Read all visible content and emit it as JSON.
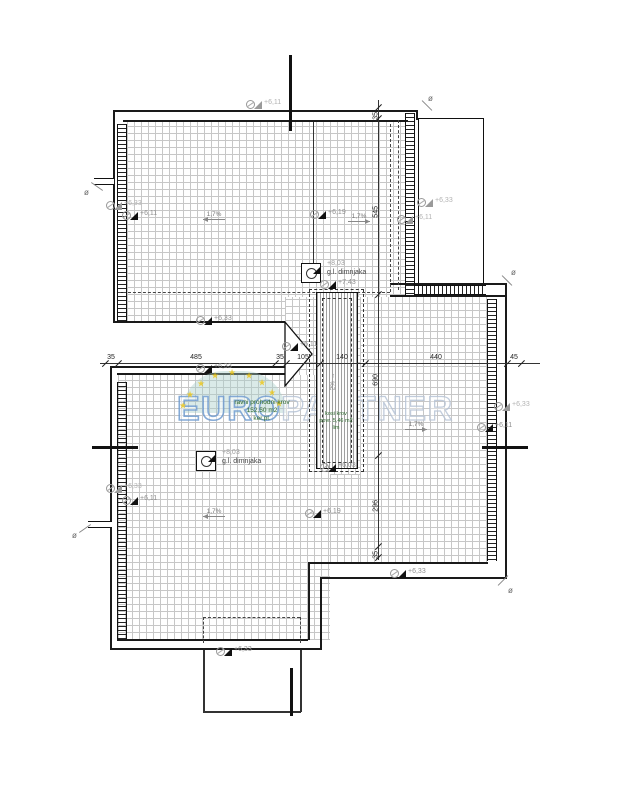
{
  "plan": {
    "watermark": {
      "euro": "EURO",
      "partner": "PARTNER"
    },
    "area_labels": {
      "flat_roof": {
        "l1": "ravni prohodni krov",
        "l2": "152,50 m2",
        "l3": "ker.pl."
      },
      "sloped_roof": {
        "l1": "kosi krov",
        "l2": "povr. 5,46 m2",
        "l3": "lim"
      }
    },
    "chimneys": [
      {
        "x": 301,
        "y": 263,
        "elev": "+8,03",
        "name": "g.l. dimnjaka",
        "lx": 327,
        "ly": 259
      },
      {
        "x": 196,
        "y": 451,
        "elev": "+8,03",
        "name": "g.l. dimnjaka",
        "lx": 222,
        "ly": 448
      }
    ],
    "h_dim": {
      "y": 363,
      "x1": 100,
      "x2": 540,
      "ticks": [
        105,
        118,
        275,
        286,
        320,
        365,
        507,
        521
      ],
      "labels": [
        {
          "t": "35",
          "x": 111
        },
        {
          "t": "485",
          "x": 196
        },
        {
          "t": "35",
          "x": 280
        },
        {
          "t": "105",
          "x": 303
        },
        {
          "t": "140",
          "x": 342
        },
        {
          "t": "440",
          "x": 436
        },
        {
          "t": "45",
          "x": 514
        }
      ]
    },
    "v_dim": {
      "x": 378,
      "y1": 100,
      "y2": 560,
      "ticks": [
        107,
        118,
        294,
        455,
        546,
        557
      ],
      "labels": [
        {
          "t": "35",
          "y": 112
        },
        {
          "t": "545",
          "y": 206
        },
        {
          "t": "690",
          "y": 374
        },
        {
          "t": "296",
          "y": 500
        },
        {
          "t": "35",
          "y": 551
        }
      ]
    },
    "elevation_markers": [
      {
        "x": 246,
        "y": 100,
        "t": "+6,11",
        "tone": "light"
      },
      {
        "x": 106,
        "y": 201,
        "t": "+6,33",
        "tone": "light"
      },
      {
        "x": 122,
        "y": 211,
        "t": "+6,11",
        "tone": "dark"
      },
      {
        "x": 310,
        "y": 210,
        "t": "+6,19",
        "tone": "dark"
      },
      {
        "x": 417,
        "y": 198,
        "t": "+6,33",
        "tone": "light"
      },
      {
        "x": 397,
        "y": 215,
        "t": "+6,11",
        "tone": "light"
      },
      {
        "x": 106,
        "y": 484,
        "t": "+6,33",
        "tone": "light"
      },
      {
        "x": 122,
        "y": 496,
        "t": "+6,11",
        "tone": "dark"
      },
      {
        "x": 305,
        "y": 509,
        "t": "+6,19",
        "tone": "dark"
      },
      {
        "x": 494,
        "y": 402,
        "t": "+6,33",
        "tone": "light"
      },
      {
        "x": 477,
        "y": 423,
        "t": "+6,11",
        "tone": "dark"
      },
      {
        "x": 390,
        "y": 569,
        "t": "+6,33",
        "tone": "dark"
      },
      {
        "x": 216,
        "y": 647,
        "t": "+6,33",
        "tone": "dark"
      },
      {
        "x": 196,
        "y": 316,
        "t": "+6,33",
        "tone": "dark"
      },
      {
        "x": 196,
        "y": 364,
        "t": "+6,33",
        "tone": "dark"
      },
      {
        "x": 282,
        "y": 342,
        "t": "+6,11",
        "tone": "dark"
      },
      {
        "x": 320,
        "y": 280,
        "t": "+7,43",
        "tone": "dark"
      },
      {
        "x": 320,
        "y": 463,
        "t": "+6,03",
        "tone": "dark"
      }
    ],
    "slope_arrows": [
      {
        "x": 203,
        "y": 211,
        "t": "1,7%",
        "dir": "left"
      },
      {
        "x": 348,
        "y": 213,
        "t": "1,7%",
        "dir": "right"
      },
      {
        "x": 203,
        "y": 508,
        "t": "1,7%",
        "dir": "left"
      },
      {
        "x": 405,
        "y": 421,
        "t": "1,7%",
        "dir": "right"
      }
    ],
    "strip_slope": "2%",
    "drain_symbol": "ø",
    "drains": [
      {
        "x": 428,
        "y": 94,
        "ang": 45,
        "lx": 420,
        "ly": 105
      },
      {
        "x": 511,
        "y": 268,
        "ang": 45,
        "lx": 500,
        "ly": 280
      },
      {
        "x": 508,
        "y": 586,
        "ang": -45,
        "lx": 496,
        "ly": 580
      },
      {
        "x": 72,
        "y": 531,
        "ang": -35,
        "lx": 78,
        "ly": 528
      },
      {
        "x": 84,
        "y": 188,
        "ang": 35,
        "lx": 90,
        "ly": 186
      }
    ],
    "stars": [
      [
        183,
        406
      ],
      [
        190,
        395
      ],
      [
        201,
        384
      ],
      [
        215,
        376
      ],
      [
        232,
        373
      ],
      [
        249,
        376
      ],
      [
        262,
        383
      ],
      [
        272,
        393
      ],
      [
        279,
        404
      ]
    ]
  }
}
